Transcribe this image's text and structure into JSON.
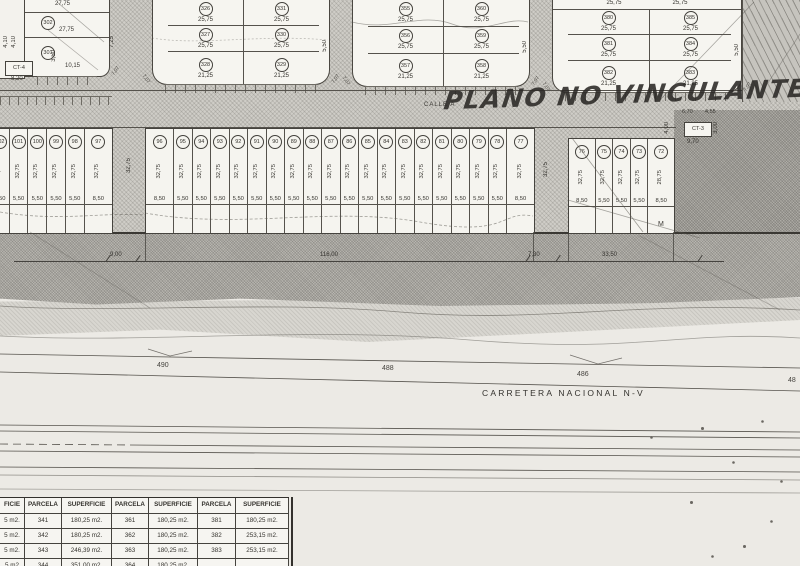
{
  "scan": {
    "handwriting": "PLANO NO VINCULANTE",
    "calle_label": "CALLE A",
    "carretera_label": "CARRETERA NACIONAL N-V",
    "m_label": "M"
  },
  "margin_left": {
    "dims": [
      "4,10",
      "4,10"
    ],
    "ct_box": "CT-4",
    "dim_below": "8,20"
  },
  "block_a": {
    "dim_top": "27,75",
    "parcel_1": "302",
    "dim_mid": "27,75",
    "parcel_2": "301",
    "dim_side": "3,50",
    "dim_inner": "10,15",
    "dim_street": "7,25",
    "curve_right": "7,07"
  },
  "block_b": {
    "left_dims": [
      "7,00",
      "7,00",
      "5,50",
      "10,00"
    ],
    "right_dim": "5,50",
    "curve_left": "7,07",
    "curve_right": "7,07",
    "col1": [
      {
        "num": "326",
        "dim": "25,75"
      },
      {
        "num": "327",
        "dim": "25,75"
      },
      {
        "num": "328",
        "dim": "21,25"
      }
    ],
    "col2": [
      {
        "num": "331",
        "dim": "25,75"
      },
      {
        "num": "330",
        "dim": "25,75"
      },
      {
        "num": "329",
        "dim": "21,25"
      }
    ]
  },
  "block_c": {
    "left_dims": [
      "7,00",
      "7,00",
      "5,50",
      "10,00"
    ],
    "right_dim": "5,50",
    "curve_left": "7,07",
    "curve_right": "7,07",
    "col1": [
      {
        "num": "355",
        "dim": "25,75"
      },
      {
        "num": "356",
        "dim": "25,75"
      },
      {
        "num": "357",
        "dim": "21,25"
      }
    ],
    "col2": [
      {
        "num": "360",
        "dim": "25,75"
      },
      {
        "num": "359",
        "dim": "25,75"
      },
      {
        "num": "358",
        "dim": "21,25"
      }
    ]
  },
  "block_d": {
    "top_dims": [
      "25,75",
      "25,75"
    ],
    "left_dims": [
      "7,00",
      "7,00",
      "5,50",
      "10,00"
    ],
    "right_dim": "5,50",
    "curve_left": "7,07",
    "curve_right": "7,07",
    "col1": [
      {
        "num": "380",
        "dim": "25,75"
      },
      {
        "num": "381",
        "dim": "25,75"
      },
      {
        "num": "382",
        "dim": "21,25"
      }
    ],
    "col2": [
      {
        "num": "385",
        "dim": "25,75"
      },
      {
        "num": "384",
        "dim": "25,75"
      },
      {
        "num": "383",
        "dim": "21,25"
      }
    ]
  },
  "ct3_area": {
    "dim_a": "6,70",
    "dim_b": "4,55",
    "ct_box": "CT-3",
    "dim_below": "9,70",
    "dim_left": "4,00",
    "dim_right": "3,00"
  },
  "mid_row": {
    "street_dim_left": "32,75",
    "street_dim_right": "32,75",
    "left_group": [
      {
        "num": "102",
        "depth": "32,75",
        "w": "5,50"
      },
      {
        "num": "101",
        "depth": "32,75",
        "w": "5,50"
      },
      {
        "num": "100",
        "depth": "32,75",
        "w": "5,50"
      },
      {
        "num": "99",
        "depth": "32,75",
        "w": "5,50"
      },
      {
        "num": "98",
        "depth": "32,75",
        "w": "5,50"
      },
      {
        "num": "97",
        "depth": "32,75",
        "w": "8,50"
      }
    ],
    "center_group": [
      {
        "num": "96",
        "depth": "32,75",
        "w": "8,50"
      },
      {
        "num": "95",
        "depth": "32,75",
        "w": "5,50"
      },
      {
        "num": "94",
        "depth": "32,75",
        "w": "5,50"
      },
      {
        "num": "93",
        "depth": "32,75",
        "w": "5,50"
      },
      {
        "num": "92",
        "depth": "32,75",
        "w": "5,50"
      },
      {
        "num": "91",
        "depth": "32,75",
        "w": "5,50"
      },
      {
        "num": "90",
        "depth": "32,75",
        "w": "5,50"
      },
      {
        "num": "89",
        "depth": "32,75",
        "w": "5,50"
      },
      {
        "num": "88",
        "depth": "32,75",
        "w": "5,50"
      },
      {
        "num": "87",
        "depth": "32,75",
        "w": "5,50"
      },
      {
        "num": "86",
        "depth": "32,75",
        "w": "5,50"
      },
      {
        "num": "85",
        "depth": "32,75",
        "w": "5,50"
      },
      {
        "num": "84",
        "depth": "32,75",
        "w": "5,50"
      },
      {
        "num": "83",
        "depth": "32,75",
        "w": "5,50"
      },
      {
        "num": "82",
        "depth": "32,75",
        "w": "5,50"
      },
      {
        "num": "81",
        "depth": "32,75",
        "w": "5,50"
      },
      {
        "num": "80",
        "depth": "32,75",
        "w": "5,50"
      },
      {
        "num": "79",
        "depth": "32,75",
        "w": "5,50"
      },
      {
        "num": "78",
        "depth": "32,75",
        "w": "5,50"
      },
      {
        "num": "77",
        "depth": "32,75",
        "w": "8,50"
      }
    ],
    "right_group": [
      {
        "num": "76",
        "depth": "32,75",
        "w": "8,50"
      },
      {
        "num": "75",
        "depth": "32,75",
        "w": "5,50"
      },
      {
        "num": "74",
        "depth": "32,75",
        "w": "5,50"
      },
      {
        "num": "73",
        "depth": "32,75",
        "w": "5,50"
      },
      {
        "num": "72",
        "depth": "28,75",
        "w": "8,50"
      }
    ]
  },
  "road": {
    "dims": [
      "9,00",
      "116,00",
      "7,30",
      "33,50"
    ]
  },
  "contours": {
    "labels": [
      "490",
      "488",
      "486",
      "48"
    ]
  },
  "table": {
    "headers": [
      "FICIE",
      "PARCELA",
      "SUPERFICIE",
      "PARCELA",
      "SUPERFICIE",
      "PARCELA",
      "SUPERFICIE"
    ],
    "rows": [
      [
        "5 m2.",
        "341",
        "180,25 m2.",
        "361",
        "180,25 m2.",
        "381",
        "180,25 m2."
      ],
      [
        "5 m2.",
        "342",
        "180,25 m2.",
        "362",
        "180,25 m2.",
        "382",
        "253,15 m2."
      ],
      [
        "5 m2.",
        "343",
        "246,39 m2.",
        "363",
        "180,25 m2.",
        "383",
        "253,15 m2."
      ],
      [
        "5 m2",
        "344",
        "351,00 m2.",
        "364",
        "180,25 m2.",
        "",
        ""
      ]
    ]
  }
}
